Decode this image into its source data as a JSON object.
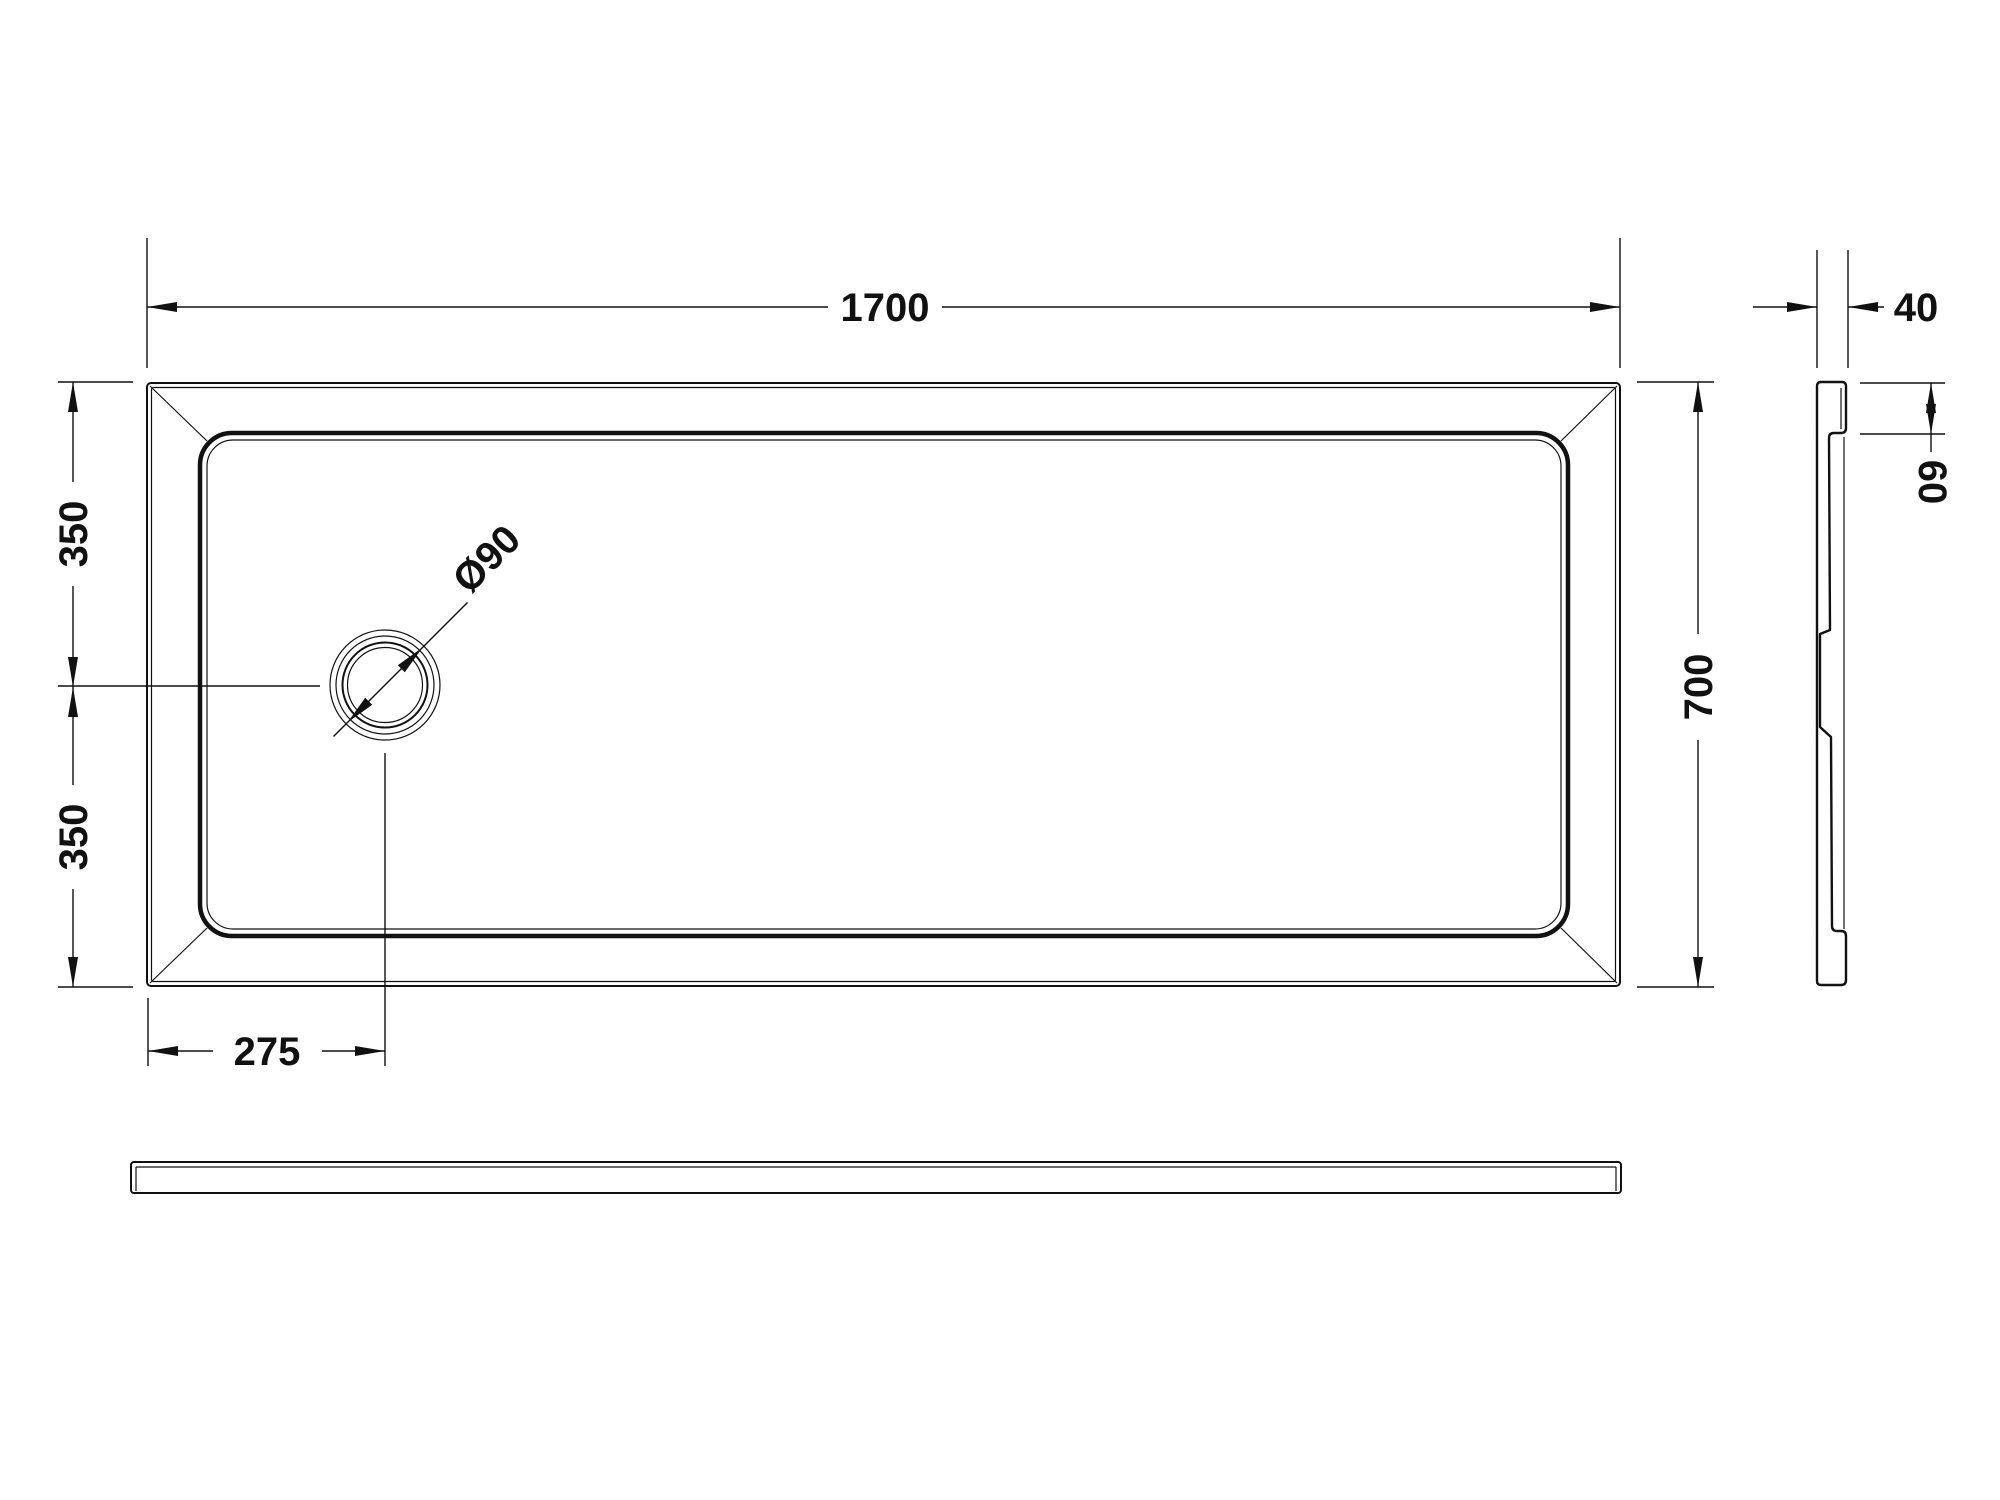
{
  "drawing": {
    "kind": "shower-tray technical drawing",
    "colors": {
      "background": "#ffffff",
      "line": "#111111"
    }
  },
  "dimensions": {
    "length": "1700",
    "width": "700",
    "tray_thickness": "40",
    "rim_depth": "60",
    "drain_center_from_top": "350",
    "drain_center_from_bottom": "350",
    "drain_center_from_left": "275",
    "drain_diameter": "Ø90"
  }
}
